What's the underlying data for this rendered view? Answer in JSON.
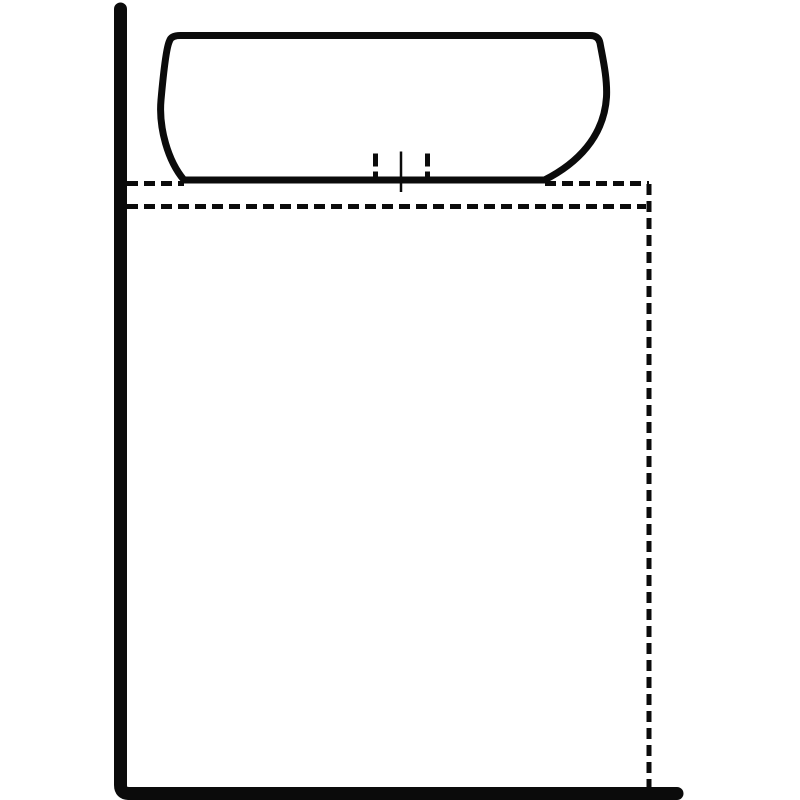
{
  "diagram": {
    "name": "vessel-sink-on-countertop-installation-diagram",
    "description": "Side-view line drawing of a vessel basin resting on a dashed countertop/cabinet outline against a wall and floor",
    "canvas": {
      "width": 800,
      "height": 800
    },
    "colors": {
      "background": "#ffffff",
      "line": "#0b0b0b",
      "basin_fill": "#ffffff"
    },
    "shapes": [
      {
        "name": "countertop-top-dashed-line-left",
        "role": "hidden-countertop-edge",
        "path": "M 127 183.5 L 184 183.5",
        "stroke_width": 5,
        "dash": "11 6"
      },
      {
        "name": "countertop-top-dashed-line-right",
        "role": "hidden-countertop-edge",
        "path": "M 545 183.5 L 649 183.5",
        "stroke_width": 5,
        "dash": "11 6"
      },
      {
        "name": "countertop-inner-dashed-line",
        "role": "hidden-countertop-front-edge",
        "path": "M 127 206.5 L 646 206.5",
        "stroke_width": 5,
        "dash": "11 6"
      },
      {
        "name": "cabinet-right-dashed-line",
        "role": "hidden-cabinet-side",
        "path": "M 649 184 L 649 787",
        "stroke_width": 5,
        "dash": "11 6"
      },
      {
        "name": "sink-basin-outline",
        "role": "vessel-basin",
        "path": "M 184 180 C 168 161 158.5 128 161 100 C 163.5 72 166.5 47 169.5 41 Q 171 35.5 180.5 35.5 L 590 35.5 Q 598.5 35.5 600 43 C 602.5 57 607.5 78 606.5 97 C 604 137 577 163.5 544.5 180 Z",
        "stroke_width": 7,
        "fill": "basin_fill",
        "join": "round"
      },
      {
        "name": "drain-left-dashed-tick",
        "role": "hidden-drain-edge-mark",
        "path": "M 375.5 153.5 L 375.5 180",
        "stroke_width": 5,
        "dash": "13 5"
      },
      {
        "name": "drain-centerline",
        "role": "drain-center-mark",
        "path": "M 401 151.5 L 401 192",
        "stroke_width": 2.5
      },
      {
        "name": "drain-right-dashed-tick",
        "role": "hidden-drain-edge-mark",
        "path": "M 427.5 153.5 L 427.5 180",
        "stroke_width": 5,
        "dash": "13 5"
      },
      {
        "name": "wall-floor-line",
        "role": "wall-and-floor",
        "path": "M 120.5 9 L 120.5 785 Q 120.5 793.5 129 793.5 L 677 793.5",
        "stroke_width": 13,
        "cap": "round",
        "join": "round"
      }
    ]
  }
}
